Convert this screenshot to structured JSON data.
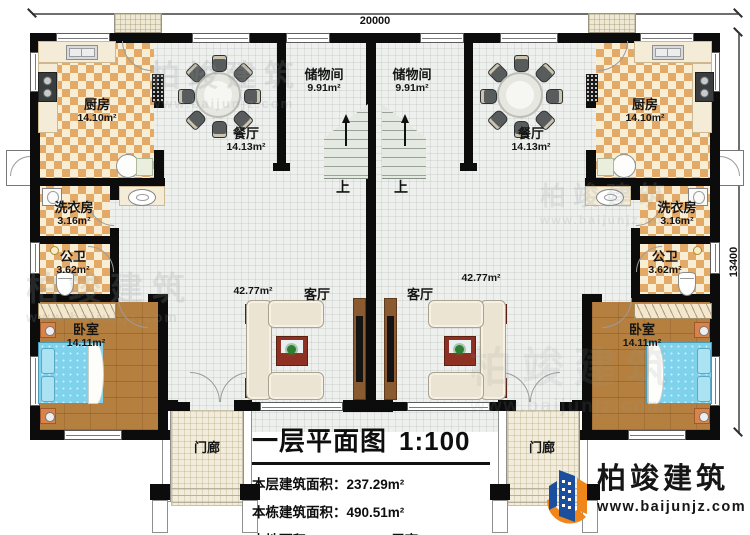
{
  "plan": {
    "type": "residential floor plan",
    "stairs_up_label": "上"
  },
  "dimensions": {
    "width_mm": "20000",
    "height_mm": "13400"
  },
  "rooms": [
    {
      "name": "厨房",
      "area": "14.10m²"
    },
    {
      "name": "餐厅",
      "area": "14.13m²"
    },
    {
      "name": "储物间",
      "area": "9.91m²"
    },
    {
      "name": "储物间",
      "area": "9.91m²"
    },
    {
      "name": "餐厅",
      "area": "14.13m²"
    },
    {
      "name": "厨房",
      "area": "14.10m²"
    },
    {
      "name": "洗衣房",
      "area": "3.16m²"
    },
    {
      "name": "公卫",
      "area": "3.62m²"
    },
    {
      "name": "卧室",
      "area": "14.11m²"
    },
    {
      "name": "洗衣房",
      "area": "3.16m²"
    },
    {
      "name": "公卫",
      "area": "3.62m²"
    },
    {
      "name": "卧室",
      "area": "14.11m²"
    },
    {
      "name": "客厅",
      "area": "42.77m²"
    },
    {
      "name": "客厅",
      "area": "42.77m²"
    },
    {
      "name": "门廊"
    },
    {
      "name": "门廊"
    }
  ],
  "title_block": {
    "title": "一层平面图",
    "scale": "1:100",
    "floor_area_label": "本层建筑面积：",
    "floor_area_value": "237.29m²",
    "building_area_label": "本栋建筑面积：",
    "building_area_value": "490.51m²",
    "footprint_label": "占地面积：",
    "footprint_value": "214.97m²",
    "height_label": "层高：",
    "height_value": "3.6m"
  },
  "branding": {
    "company": "柏竣建筑",
    "website": "www.baijunjz.com"
  },
  "watermark": {
    "company": "柏竣建筑",
    "website": "www.baijunjz.com"
  },
  "colors": {
    "wall": "#0c0c0c",
    "tile_floor": "#eef0ee",
    "checker_tile": "#e3a967",
    "checker_cream": "#f8eed6",
    "wood_floor": "#b5803f",
    "bed_blue": "#7ed2ec",
    "sofa_beige": "#ece4d2",
    "accent_red": "#8e3122",
    "porch_floor": "#f1ecdb",
    "logo_blue": "#1b4f9d",
    "logo_orange": "#f08519"
  }
}
